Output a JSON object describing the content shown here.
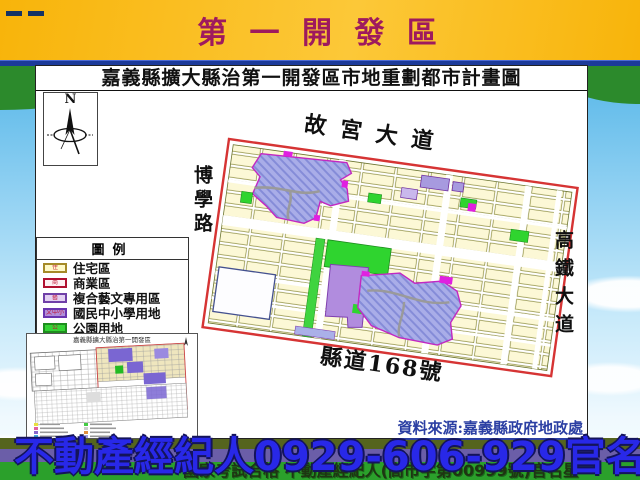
{
  "banner": {
    "title": "第 一 開 發 區"
  },
  "panel": {
    "title": "嘉義縣擴大縣治第一開發區市地重劃都市計畫圖",
    "compass_label": "N",
    "source_note": "資料來源:嘉義縣政府地政處"
  },
  "legend": {
    "header": "圖例",
    "items": [
      {
        "swatch": "住",
        "label": "住宅區",
        "fill": "#FEF9C8",
        "border": "#A58A28"
      },
      {
        "swatch": "商",
        "label": "商業區",
        "fill": "#FDEFF2",
        "border": "#B01030"
      },
      {
        "swatch": "藝",
        "label": "複合藝文專用區",
        "fill": "#E3D1F2",
        "border": "#7040A8"
      },
      {
        "swatch": "文中小",
        "label": "國民中小學用地",
        "fill": "#B18FD9",
        "border": "#6A35B0"
      },
      {
        "swatch": "公",
        "label": "公園用地",
        "fill": "#35D435",
        "border": "#1E8E1E"
      }
    ]
  },
  "map": {
    "road_top": "故宮大道",
    "road_left": "博學路",
    "road_right": "高鐵大道",
    "road_bottom": "縣道168號",
    "boundary_color": "#D63434",
    "residential_color": "#FCF8D6",
    "school_color": "#A9ADE8",
    "arts_color": "#B18CDE",
    "park_color": "#2FD42F",
    "commercial_color": "#E020E0"
  },
  "inset": {
    "title": "嘉義縣擴大縣治第一開發區"
  },
  "footer": {
    "main": "不動產經紀人0929-606-929官名星",
    "sub": "國家考試合格 不動產經紀人(高市字第00999號)官名星"
  },
  "colors": {
    "banner_bg": "#F8B40A",
    "banner_text": "#9E1A5E",
    "divider": "#1C3A9A",
    "footer_text": "#2828E8",
    "hill_green": "#2BA02B",
    "hill_stripe": "#6B5EA8",
    "sky": "#55B6E8"
  }
}
